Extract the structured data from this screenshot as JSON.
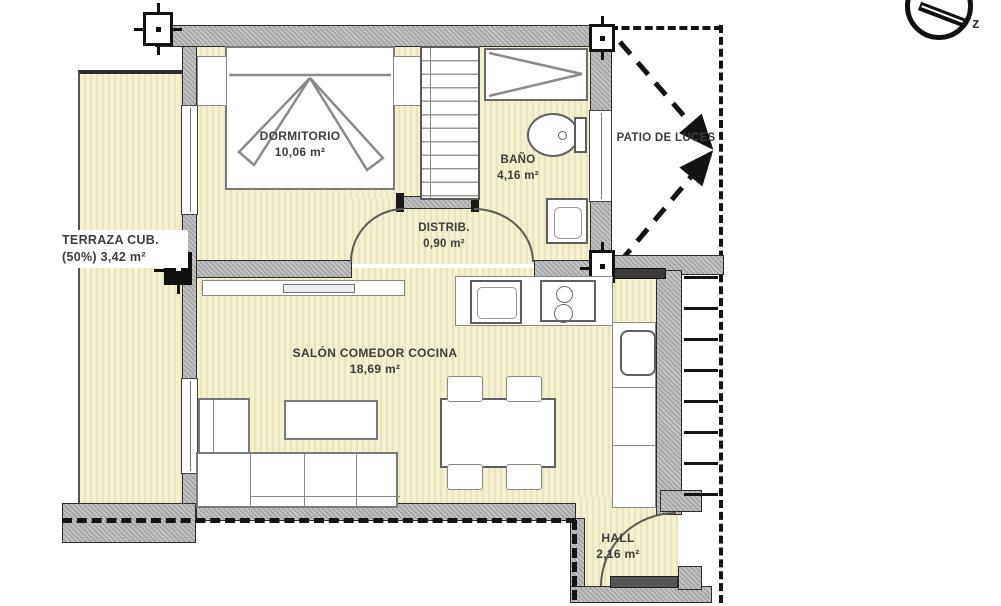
{
  "plan": {
    "rooms": [
      {
        "name": "DORMITORIO",
        "area": "10,06 m²"
      },
      {
        "name": "BAÑO",
        "area": "4,16 m²"
      },
      {
        "name": "PATIO DE LUCES",
        "area": ""
      },
      {
        "name": "TERRAZA CUB.",
        "area": "(50%) 3,42 m²"
      },
      {
        "name": "DISTRIB.",
        "area": "0,90 m²"
      },
      {
        "name": "SALÓN COMEDOR COCINA",
        "area": "18,69 m²"
      },
      {
        "name": "HALL",
        "area": "2,16 m²"
      }
    ],
    "compass": {
      "label": "z"
    },
    "colors": {
      "room_fill": "#f5f0cf",
      "room_stripe": "#e9e3c0",
      "wall_gray": "#a6a6a6",
      "line_black": "#1c1c1c"
    }
  }
}
